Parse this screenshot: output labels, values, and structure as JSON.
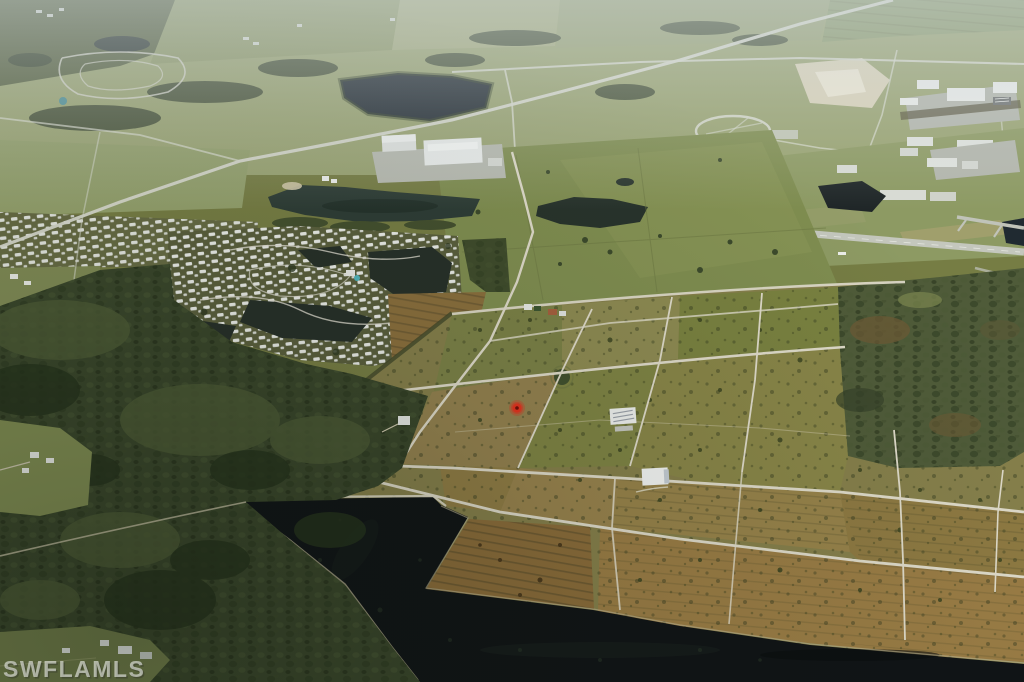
{
  "scene": {
    "type": "oblique-aerial-photograph",
    "description": "Oblique aerial photo of a semi-rural Florida landscape: a grid of vacant subdivided lots with light dirt roads surrounding a red property marker, a mobile-home community with lagoons at upper left, a warehouse complex and ponds, an airport runway at upper right, dense woods on the left, and dark canals across the bottom.",
    "watermark": {
      "text": "SWFLAMLS",
      "color": "#ffffff"
    },
    "marker": {
      "name": "property-location-marker",
      "color": "#e2331f",
      "center_x": 517,
      "center_y": 408
    }
  },
  "palette": {
    "water": "#101416",
    "lake": "#232c33",
    "pond": "#2e3d36",
    "forest": "#39462b",
    "scrub": "#4f5b39",
    "pasture": "#7f8d50",
    "field_olive": "#857f4b",
    "field_tan": "#93814f",
    "field_rust": "#997c45",
    "field_brown": "#8a6c3a",
    "road": "#ddd9c8",
    "runway": "#c4c7bd",
    "rooftop": "#eceeec",
    "haze": "#cdd6da"
  }
}
